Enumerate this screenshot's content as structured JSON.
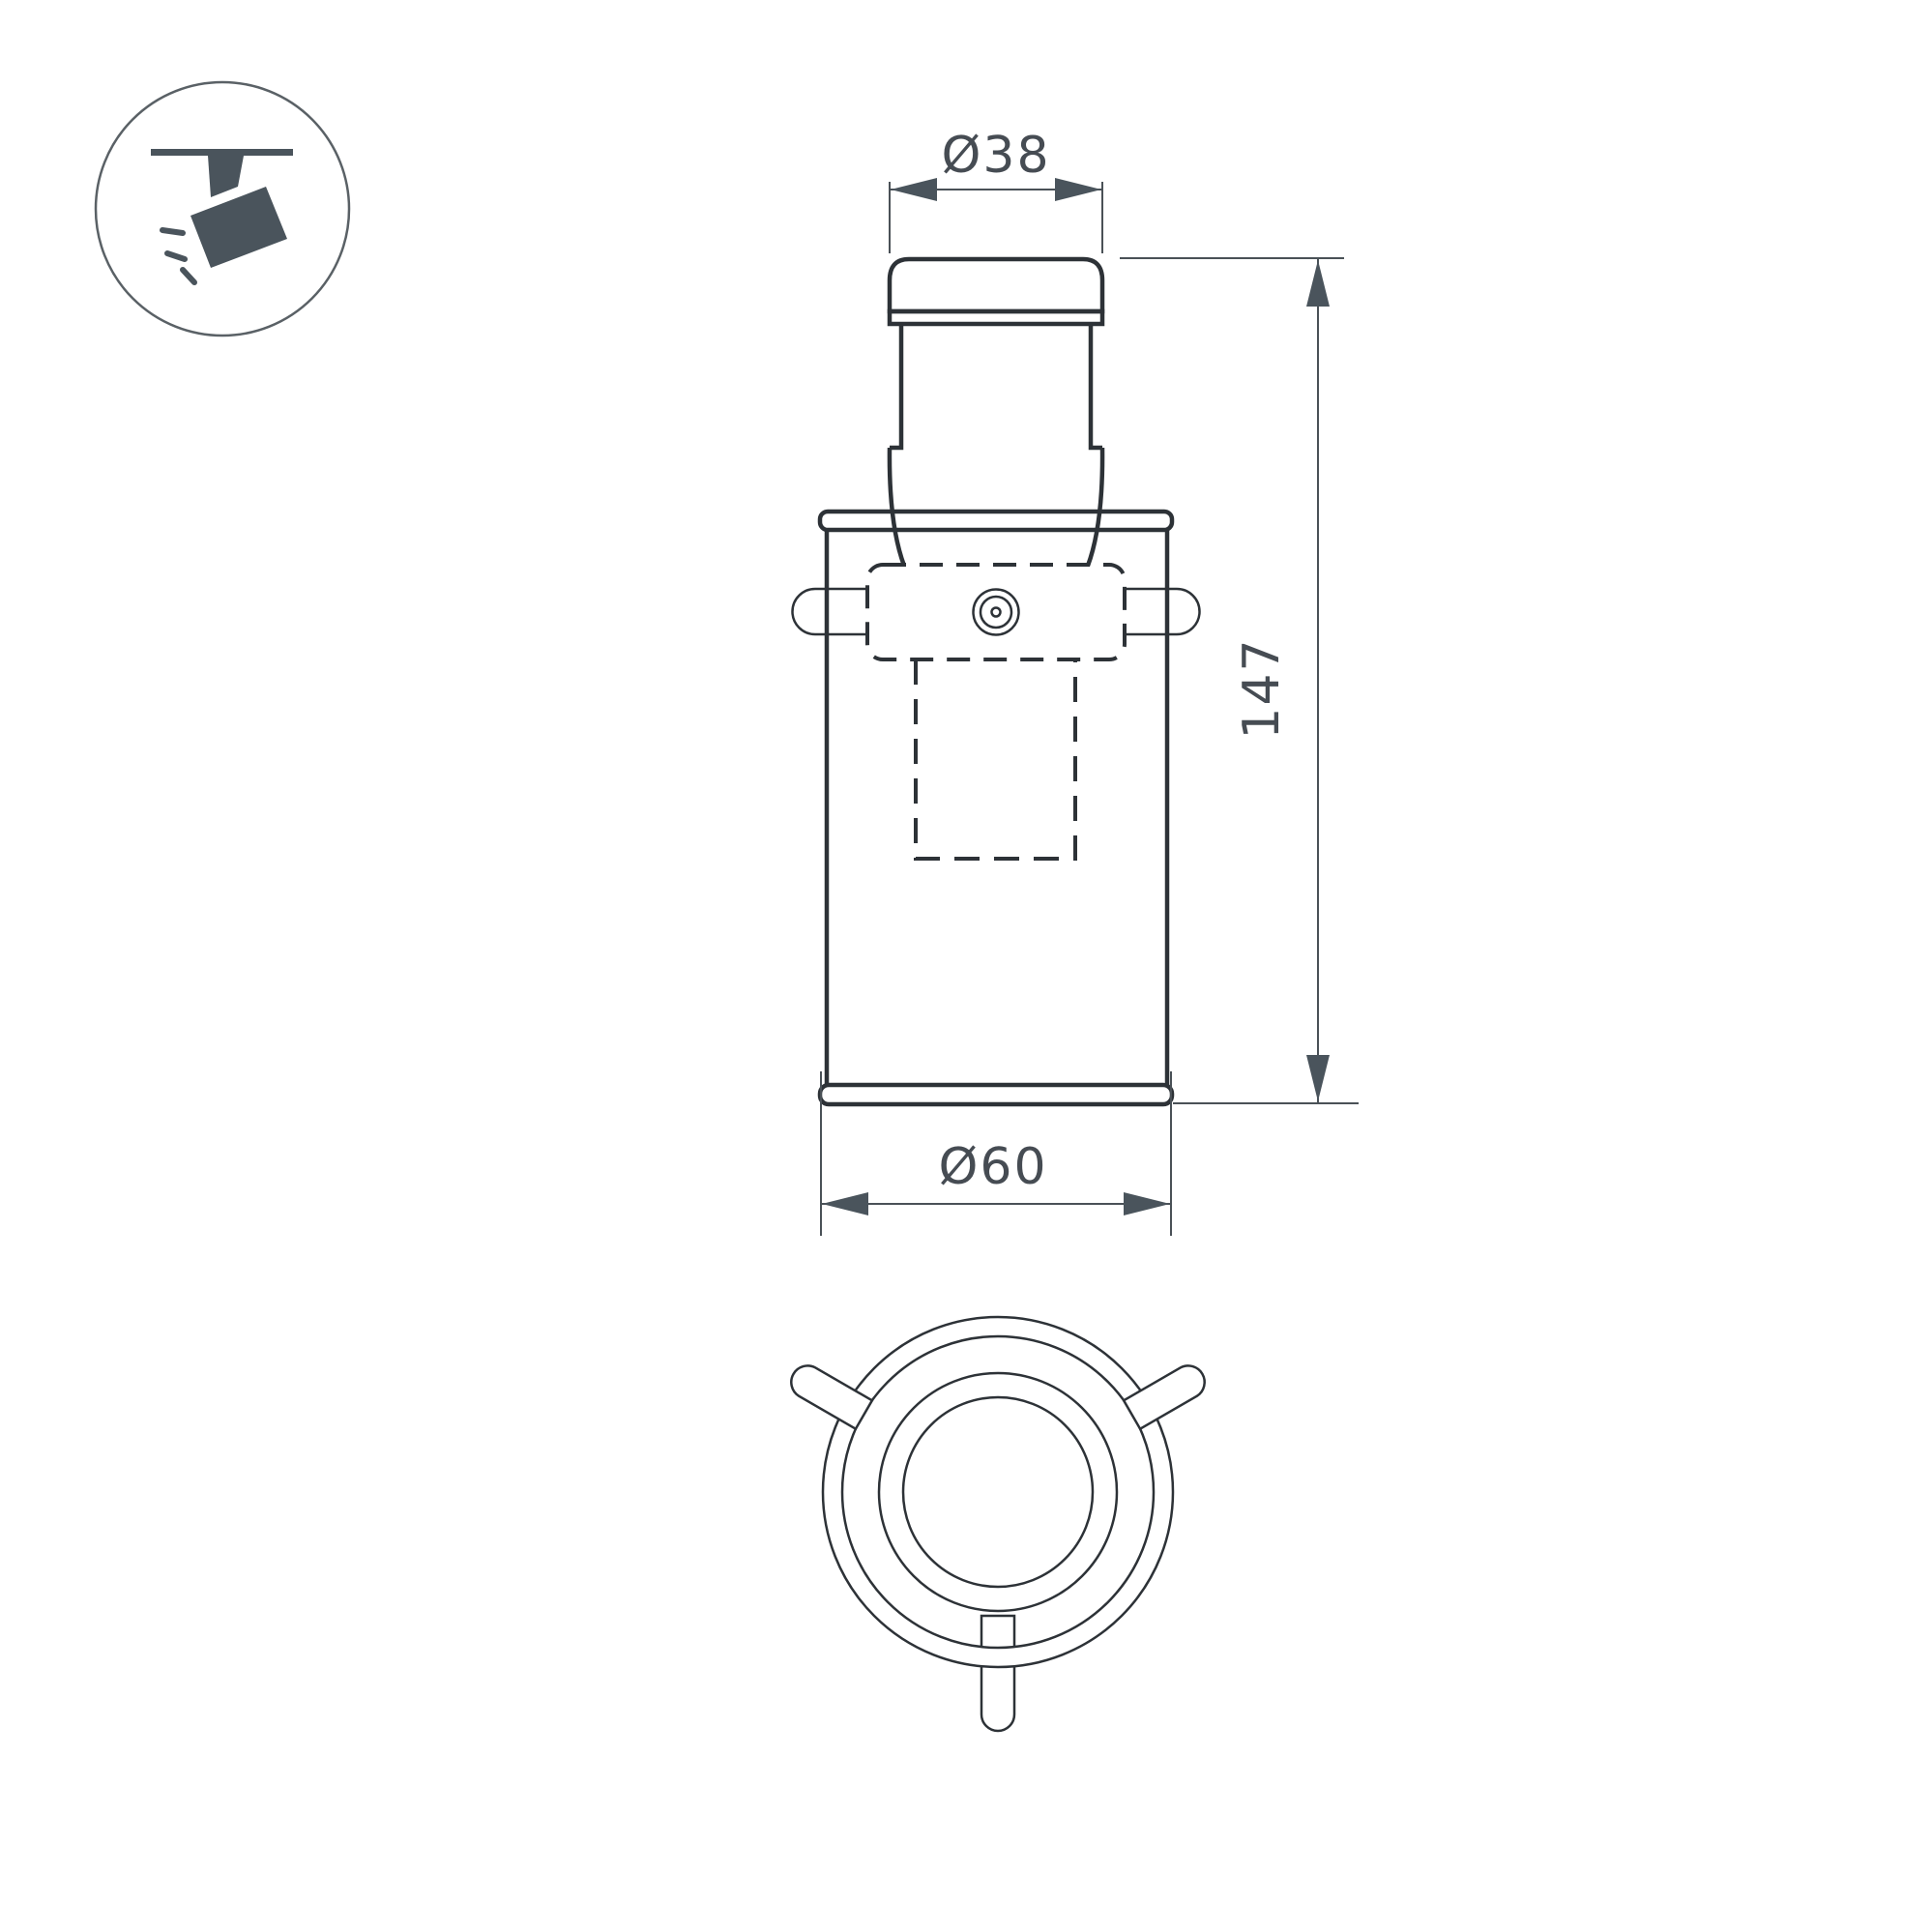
{
  "page": {
    "background_color": "#ffffff",
    "type": "technical-drawing"
  },
  "icon": {
    "name": "ceiling-track-spotlight-icon",
    "fill_color": "#4a545c",
    "circle_stroke_color": "#5a6166"
  },
  "drawing": {
    "outline_color": "#2d3237",
    "dimension_line_color": "#4a5157",
    "dimension_text_color": "#464c53",
    "dimensions": {
      "head_diameter_label": "Ø38",
      "overall_height_label": "147",
      "body_diameter_label": "Ø60"
    }
  }
}
